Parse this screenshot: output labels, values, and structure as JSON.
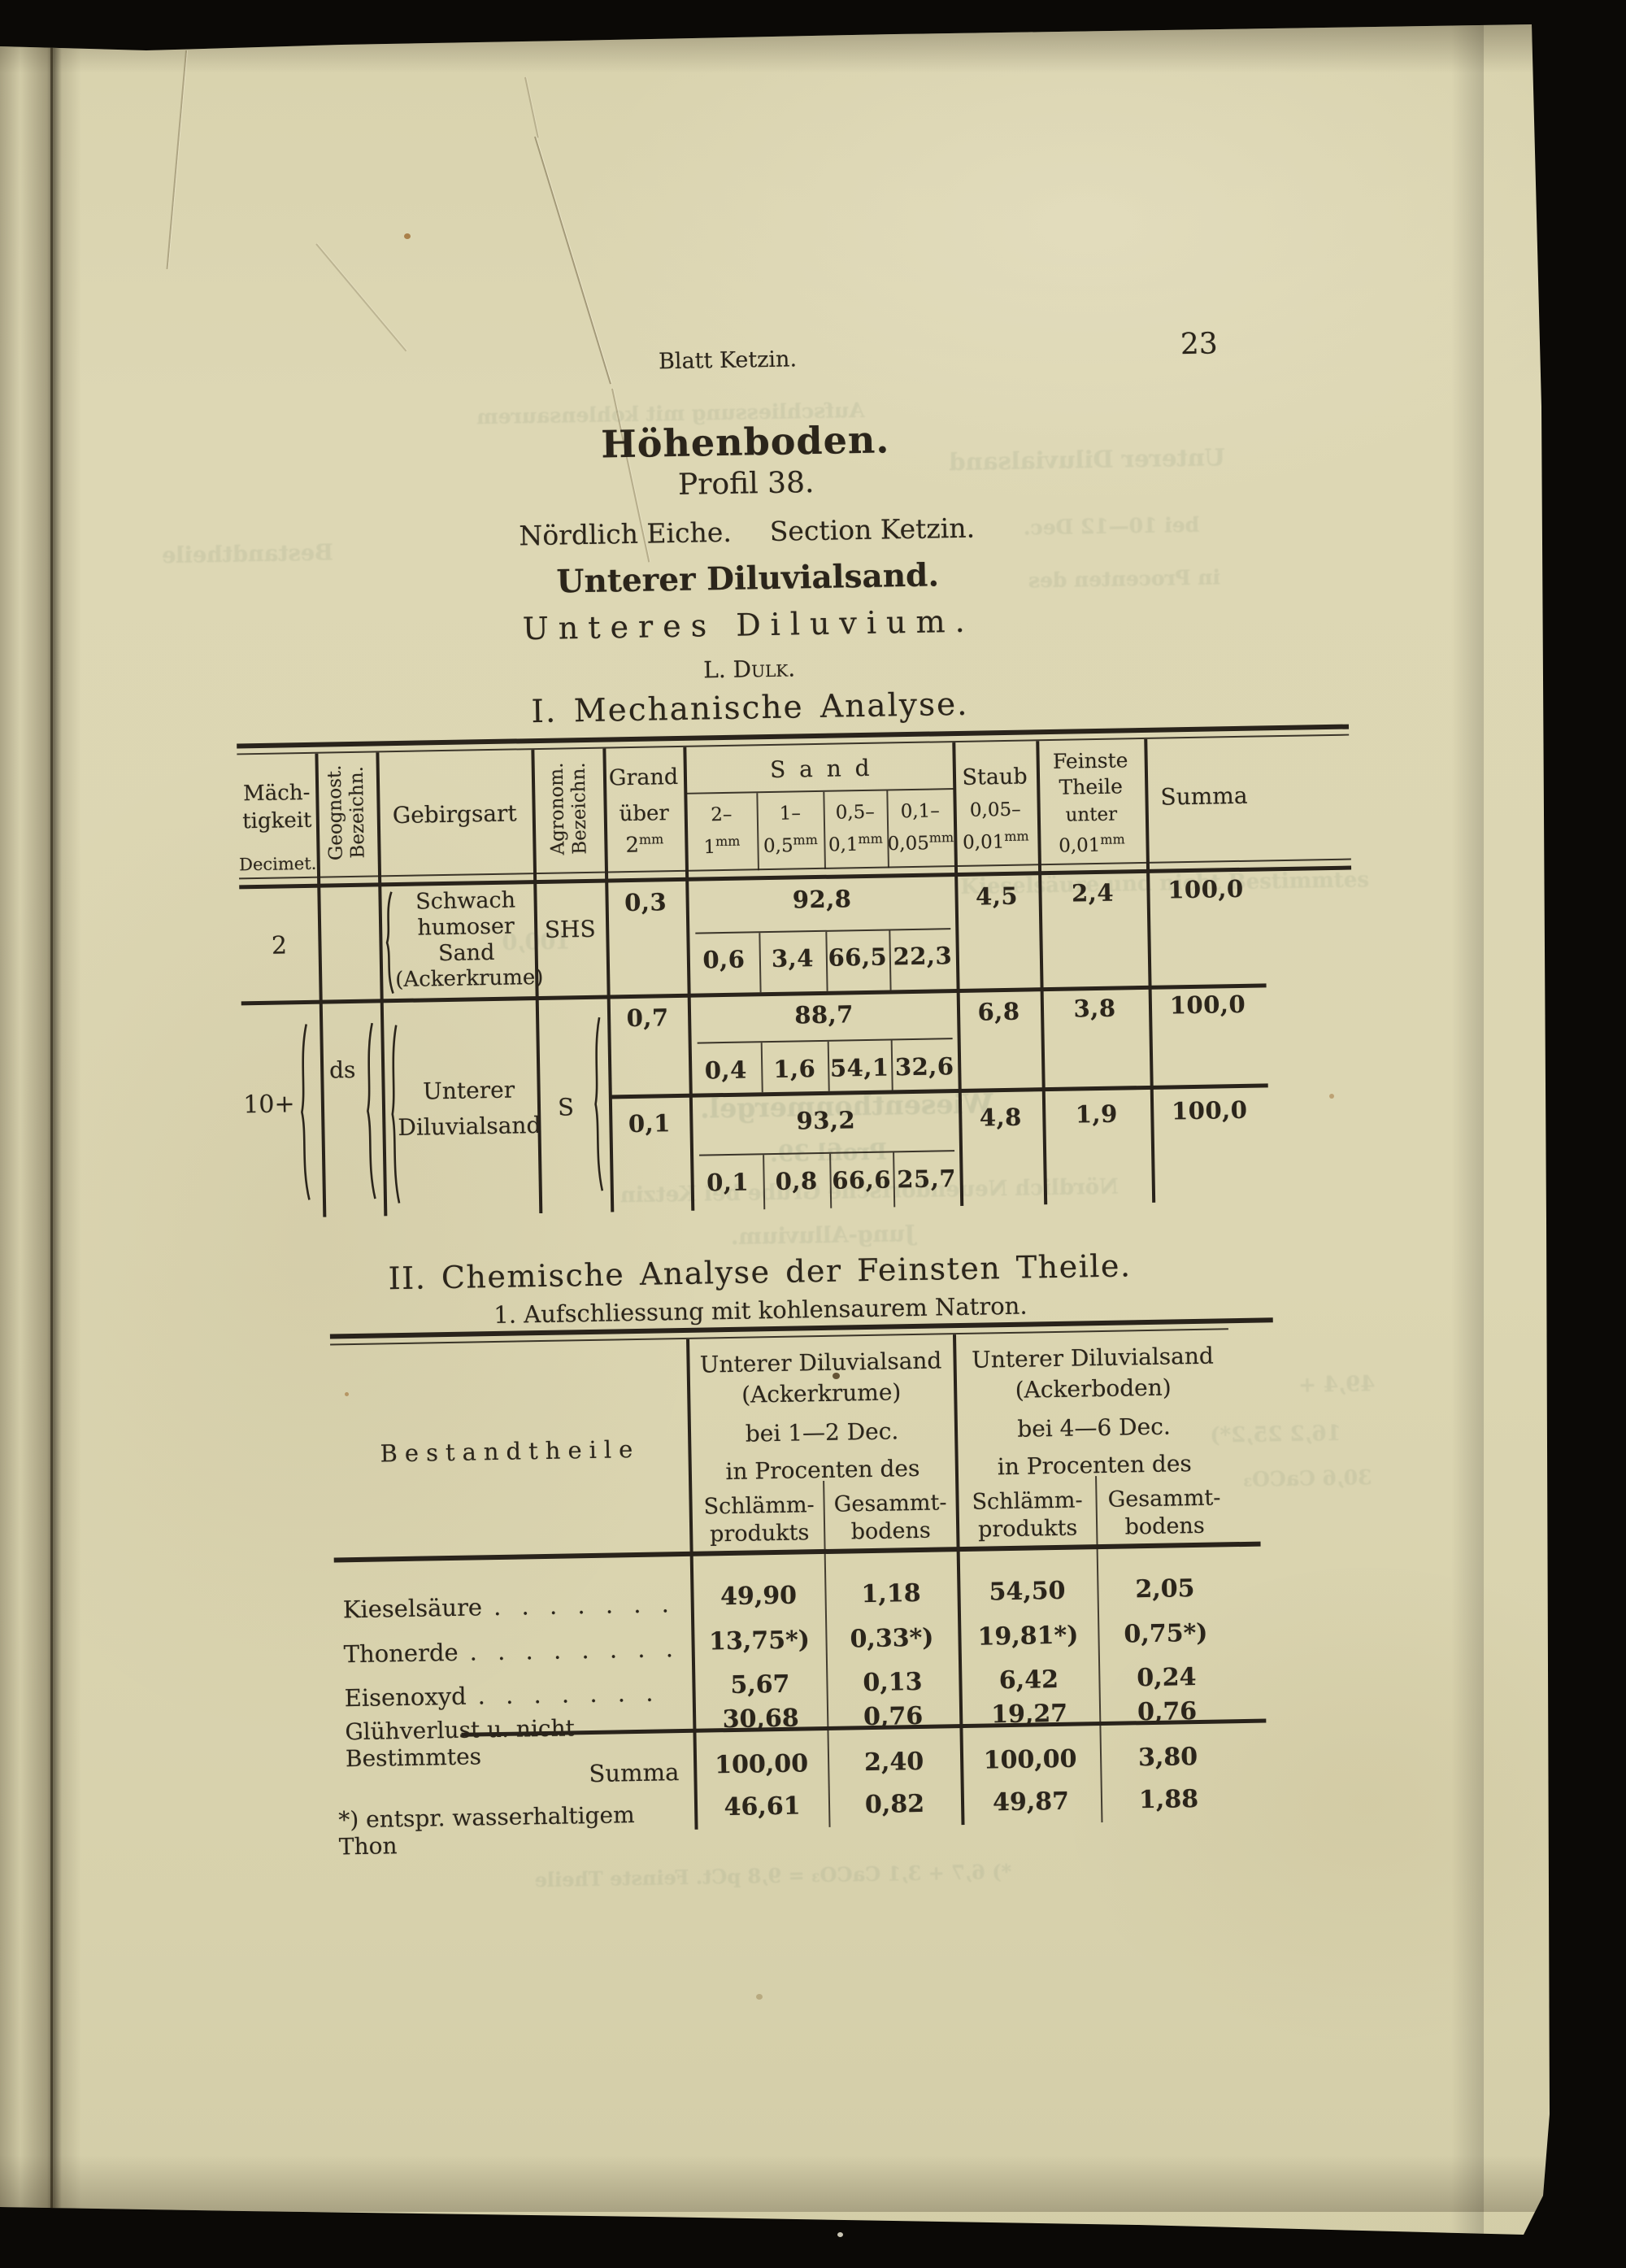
{
  "theme": {
    "paper": "#dcd6b2",
    "ink": "#2b251b",
    "background": "#0b0906"
  },
  "page": {
    "running_header": "Blatt Ketzin.",
    "page_number": "23"
  },
  "titles": {
    "main": "Höhenboden.",
    "profil": "Profil 38.",
    "location_a": "Nördlich Eiche.",
    "location_b": "Section Ketzin.",
    "material": "Unterer Diluvialsand.",
    "stratum": "Unteres Diluvium.",
    "analyst": "L. Dulk.",
    "section1": "I.  Mechanische Analyse.",
    "section2": "II.  Chemische Analyse der Feinsten Theile.",
    "section2_sub": "1.  Aufschliessung mit kohlensaurem Natron."
  },
  "table1": {
    "header": {
      "maechtigkeit_l1": "Mäch-",
      "maechtigkeit_l2": "tigkeit",
      "maechtigkeit_unit": "Decimet.",
      "geognost_l1": "Geognost.",
      "geognost_l2": "Bezeichn.",
      "gebirgsart": "Gebirgsart",
      "agronom_l1": "Agronom.",
      "agronom_l2": "Bezeichn.",
      "grand_l1": "Grand",
      "grand_l2": "über",
      "grand_num": "2",
      "grand_unit": "mm",
      "sand": "S a n d",
      "sand_subs": [
        {
          "from": "2–",
          "to": "1",
          "unit": "mm"
        },
        {
          "from": "1–",
          "to": "0,5",
          "unit": "mm"
        },
        {
          "from": "0,5–",
          "to": "0,1",
          "unit": "mm"
        },
        {
          "from": "0,1–",
          "to": "0,05",
          "unit": "mm"
        }
      ],
      "staub_l1": "Staub",
      "staub_from": "0,05–",
      "staub_to": "0,01",
      "staub_unit": "mm",
      "feinste_l1": "Feinste",
      "feinste_l2": "Theile",
      "feinste_l3": "unter",
      "feinste_num": "0,01",
      "feinste_unit": "mm",
      "summa": "Summa"
    },
    "block1": {
      "maechtigkeit": "2",
      "gebirgsart_l1": "Schwach",
      "gebirgsart_l2": "humoser",
      "gebirgsart_l3": "Sand",
      "gebirgsart_l4": "(Ackerkrume)",
      "agronom": "SHS",
      "grand": "0,3",
      "sand_total": "92,8",
      "sand_parts": [
        "0,6",
        "3,4",
        "66,5",
        "22,3"
      ],
      "staub": "4,5",
      "feinste": "2,4",
      "summa": "100,0"
    },
    "block2": {
      "maechtigkeit": "10+",
      "geognost": "ds",
      "gebirgsart_l1": "Unterer",
      "gebirgsart_l2": "Diluvialsand",
      "agronom": "S",
      "sub_rows": [
        {
          "grand": "0,7",
          "sand_total": "88,7",
          "sand_parts": [
            "0,4",
            "1,6",
            "54,1",
            "32,6"
          ],
          "staub": "6,8",
          "feinste": "3,8",
          "summa": "100,0"
        },
        {
          "grand": "0,1",
          "sand_total": "93,2",
          "sand_parts": [
            "0,1",
            "0,8",
            "66,6",
            "25,7"
          ],
          "staub": "4,8",
          "feinste": "1,9",
          "summa": "100,0"
        }
      ]
    }
  },
  "table2": {
    "col_label": "Bestandtheile",
    "groups": [
      {
        "name_l1": "Unterer Diluvialsand",
        "name_l2": "(Ackerkrume)",
        "depth": "bei 1—2 Dec.",
        "percent_of": "in Procenten des",
        "sub1_l1": "Schlämm-",
        "sub1_l2": "produkts",
        "sub2_l1": "Gesammt-",
        "sub2_l2": "bodens"
      },
      {
        "name_l1": "Unterer Diluvialsand",
        "name_l2": "(Ackerboden)",
        "depth": "bei 4—6 Dec.",
        "percent_of": "in Procenten des",
        "sub1_l1": "Schlämm-",
        "sub1_l2": "produkts",
        "sub2_l1": "Gesammt-",
        "sub2_l2": "bodens"
      }
    ],
    "rows": [
      {
        "label": "Kieselsäure",
        "leader": ". . . . . . .",
        "values": [
          "49,90",
          "1,18",
          "54,50",
          "2,05"
        ]
      },
      {
        "label": "Thonerde",
        "leader": ". . . . . . . .",
        "values": [
          "13,75*)",
          "0,33*)",
          "19,81*)",
          "0,75*)"
        ]
      },
      {
        "label": "Eisenoxyd",
        "leader": ". . . . . . .",
        "values": [
          "5,67",
          "0,13",
          "6,42",
          "0,24"
        ]
      },
      {
        "label": "Glühverlust u. nicht Bestimmtes",
        "leader": "",
        "values": [
          "30,68",
          "0,76",
          "19,27",
          "0,76"
        ]
      }
    ],
    "summa_row": {
      "label": "Summa",
      "values": [
        "100,00",
        "2,40",
        "100,00",
        "3,80"
      ]
    },
    "footnote_row": {
      "label": "*) entspr. wasserhaltigem Thon",
      "values": [
        "46,61",
        "0,82",
        "49,87",
        "1,88"
      ]
    }
  },
  "bleedthrough": [
    {
      "text": "Aufschliessung mit kohlensaurem"
    },
    {
      "text": "Unterer Diluvialsand"
    },
    {
      "text": "Bestandtheile"
    },
    {
      "text": "bei 10—12 Dec."
    },
    {
      "text": "in Procenten des"
    },
    {
      "text": "100,0"
    },
    {
      "text": "Kieselsäure und nicht Bestimmtes"
    },
    {
      "text": "Wiesenthonmergel."
    },
    {
      "text": "Profil 39."
    },
    {
      "text": "Nördlich Neuendorfsche Grube bei Ketzin"
    },
    {
      "text": "Jung-Alluvium."
    },
    {
      "text": "49,4 +"
    },
    {
      "text": "16,2  25,2*)"
    },
    {
      "text": "30,6 CaCO₃"
    },
    {
      "text": "*) 6,7 + 3,1 CaCO₃ = 9,8 pCt. Feinste Theile"
    }
  ]
}
